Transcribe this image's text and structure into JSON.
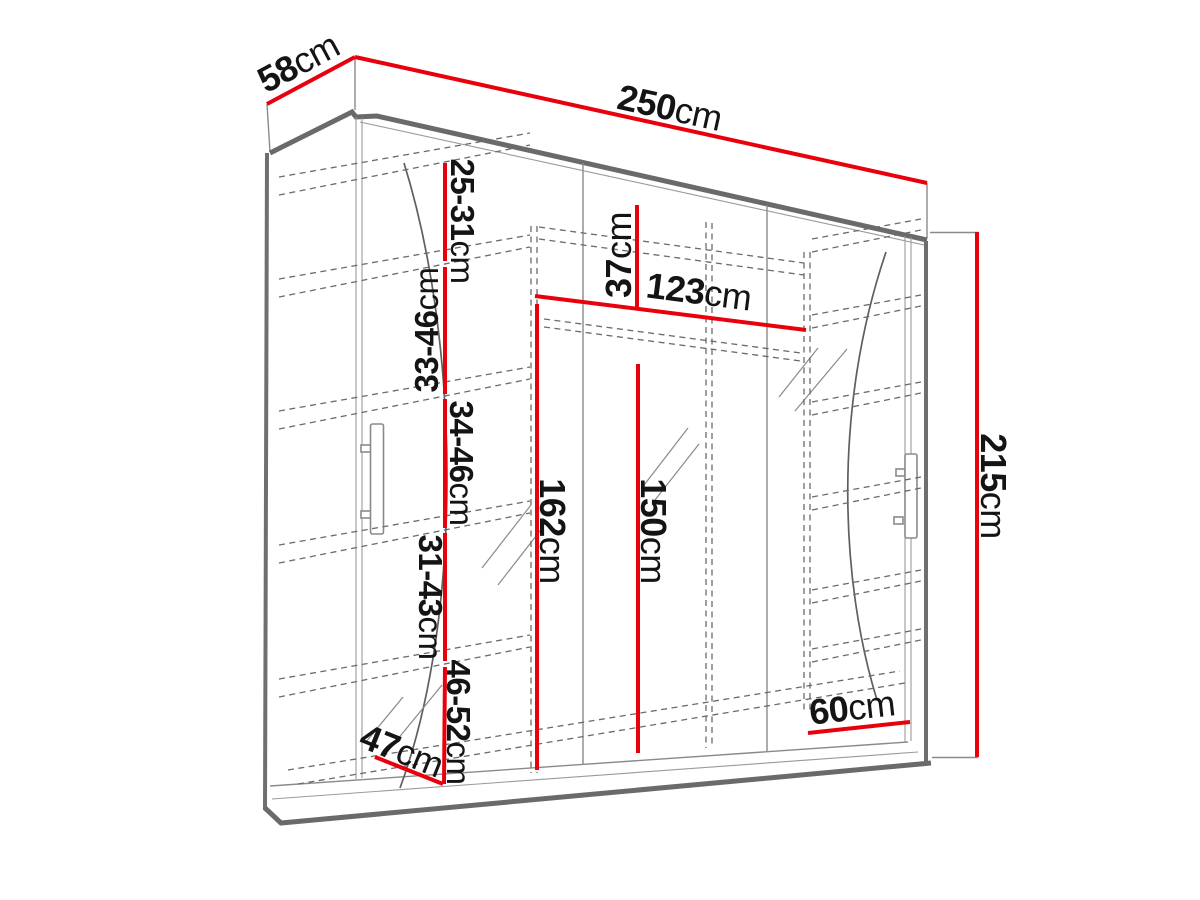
{
  "diagram": {
    "type": "furniture-dimension-diagram",
    "subject": "three-door sliding wardrobe with interior shelves",
    "colors": {
      "dimension_line": "#e8000d",
      "outline": "#6a6a6a",
      "label_text": "#141414",
      "background": "#ffffff"
    }
  },
  "dims": {
    "width": {
      "value": "250",
      "unit": "cm"
    },
    "depth": {
      "value": "58",
      "unit": "cm"
    },
    "height": {
      "value": "215",
      "unit": "cm"
    },
    "top_compartment": {
      "value": "37",
      "unit": "cm"
    },
    "rail_width": {
      "value": "123",
      "unit": "cm"
    },
    "interior_162": {
      "value": "162",
      "unit": "cm"
    },
    "interior_150": {
      "value": "150",
      "unit": "cm"
    },
    "right_section": {
      "value": "60",
      "unit": "cm"
    },
    "left_section": {
      "value": "47",
      "unit": "cm"
    },
    "shelf_gap_1": {
      "value": "25-31",
      "unit": "cm"
    },
    "shelf_gap_2": {
      "value": "33-46",
      "unit": "cm"
    },
    "shelf_gap_3": {
      "value": "34-46",
      "unit": "cm"
    },
    "shelf_gap_4": {
      "value": "31-43",
      "unit": "cm"
    },
    "shelf_gap_5": {
      "value": "46-52",
      "unit": "cm"
    }
  }
}
